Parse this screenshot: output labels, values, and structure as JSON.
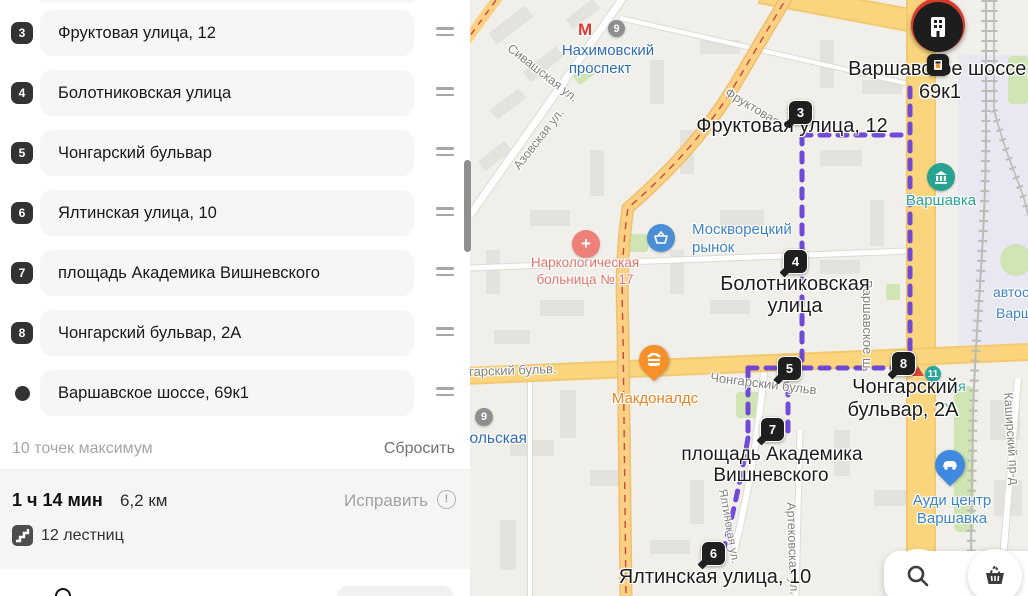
{
  "sidebar": {
    "waypoints": [
      {
        "badge": "3",
        "address": "Фруктовая улица, 12",
        "end": false
      },
      {
        "badge": "4",
        "address": "Болотниковская улица",
        "end": false
      },
      {
        "badge": "5",
        "address": "Чонгарский бульвар",
        "end": false
      },
      {
        "badge": "6",
        "address": "Ялтинская улица, 10",
        "end": false
      },
      {
        "badge": "7",
        "address": "площадь Академика Вишневского",
        "end": false
      },
      {
        "badge": "8",
        "address": "Чонгарский бульвар, 2А",
        "end": false
      },
      {
        "badge": "",
        "address": "Варшавское шоссе, 69к1",
        "end": true
      }
    ],
    "note": "10 точек максимум",
    "reset": "Сбросить",
    "summary": {
      "time": "1 ч 14 мин",
      "distance": "6,2 км",
      "fix": "Исправить",
      "warn": "!",
      "stairs": "12 лестниц"
    }
  },
  "map": {
    "badges": {
      "b3": "3",
      "b4": "4",
      "b5": "5",
      "b6": "6",
      "b7": "7",
      "b8": "8"
    },
    "labels": {
      "dest1": "Варшавское шоссе,",
      "dest2": "69к1",
      "p3": "Фруктовая улица, 12",
      "p4a": "Болотниковская",
      "p4b": "улица",
      "p7a": "площадь Академика",
      "p7b": "Вишневского",
      "p8a": "Чонгарский",
      "p8b": "бульвар, 2А",
      "p6": "Ялтинская улица, 10"
    },
    "pois": {
      "metro_m": "М",
      "metro_line9": "9",
      "metro_name1": "Нахимовский",
      "metro_name2": "проспект",
      "hospital1": "Наркологическая",
      "hospital2": "больница № 17",
      "market1": "Москворецкий",
      "market2": "рынок",
      "mcdonalds": "Макдоналдс",
      "varshavka": "Варшавка",
      "audi1": "Ауди центр",
      "audi2": "Варшавка",
      "metro_line9b": "9",
      "sevastopolskaya_frag": "польская",
      "line11": "11",
      "varshavskaya_frag1": "ая",
      "varshavskaya_frag2": ")",
      "auto_frag1": "автос",
      "auto_frag2": "Варш"
    },
    "streets": {
      "sivashskaya": "Сивашская ул.",
      "azovskaya": "Азовская ул.",
      "fruktovaya": "Фруктовая",
      "chongarsky_left": "Чонгарский бульв.",
      "chongarsky_mid": "Чонгарский бульв",
      "varshavskoe": "Варшавское ш.",
      "kashirsky": "Каширский пр-д",
      "artekovskaya": "Артековская ул.",
      "yaltinskaya": "Ялтинская ул."
    },
    "colors": {
      "route": "#6a41d6",
      "road_main": "#fbd57e",
      "poi_blue": "#3f82c4",
      "poi_red": "#ef8079",
      "poi_teal": "#28a391",
      "poi_orange": "#ef8f1f",
      "metro_red": "#e0392f",
      "text_blue": "#2e6cb5"
    }
  }
}
